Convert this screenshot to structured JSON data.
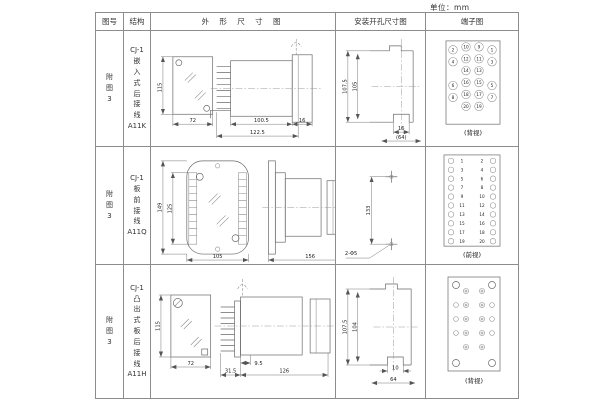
{
  "unit_label": "单位：mm",
  "header": {
    "col_fig": "图号",
    "col_structure": "结构",
    "col_outline": "外 形 尺 寸 图",
    "col_install": "安装开孔尺寸图",
    "col_terminal": "端子图"
  },
  "rows": [
    {
      "fig": "附\n图\n3",
      "structure": "CJ-1\n嵌\n入\n式\n后\n接\n线\nA11K",
      "outline": {
        "front_h": "115",
        "front_w": "72",
        "dim_body": "100.5",
        "dim_total": "122.5",
        "dim_flange": "16"
      },
      "install": {
        "dim_h_outer": "107.5",
        "dim_h_inner": "105",
        "dim_slot": "16",
        "dim_width": "(64)"
      },
      "terminal": {
        "caption": "(背视)",
        "cells": [
          [
            "2",
            "10",
            "9",
            "1"
          ],
          [
            "4",
            "12",
            "11",
            "3"
          ],
          [
            "",
            "14",
            "13",
            ""
          ],
          [
            "6",
            "16",
            "15",
            "5"
          ],
          [
            "8",
            "18",
            "17",
            "7"
          ],
          [
            "",
            "20",
            "19",
            ""
          ]
        ]
      }
    },
    {
      "fig": "附\n图\n3",
      "structure": "CJ-1\n板\n前\n接\n线\nA11Q",
      "outline": {
        "front_h": "149",
        "front_inner": "125",
        "front_w": "105",
        "side_len": "156",
        "side_h": "113"
      },
      "install": {
        "dim_pitch": "133",
        "holes": "2-Φ5"
      },
      "terminal": {
        "caption": "(前视)",
        "pairs": [
          [
            "1",
            "2"
          ],
          [
            "3",
            "4"
          ],
          [
            "5",
            "6"
          ],
          [
            "7",
            "8"
          ],
          [
            "9",
            "10"
          ],
          [
            "11",
            "12"
          ],
          [
            "13",
            "14"
          ],
          [
            "15",
            "16"
          ],
          [
            "17",
            "18"
          ],
          [
            "19",
            "20"
          ]
        ]
      }
    },
    {
      "fig": "附\n图\n3",
      "structure": "CJ-1\n凸\n出\n式\n板\n后\n接\n线\nA11H",
      "outline": {
        "front_h": "115",
        "front_w": "72",
        "dim_pins": "31.5",
        "dim_offset": "9.5",
        "dim_total": "126"
      },
      "install": {
        "dim_h_outer": "107.5",
        "dim_h_inner": "104",
        "dim_slot": "10",
        "dim_width": "64"
      },
      "terminal": {
        "caption": "(背视)"
      }
    }
  ]
}
